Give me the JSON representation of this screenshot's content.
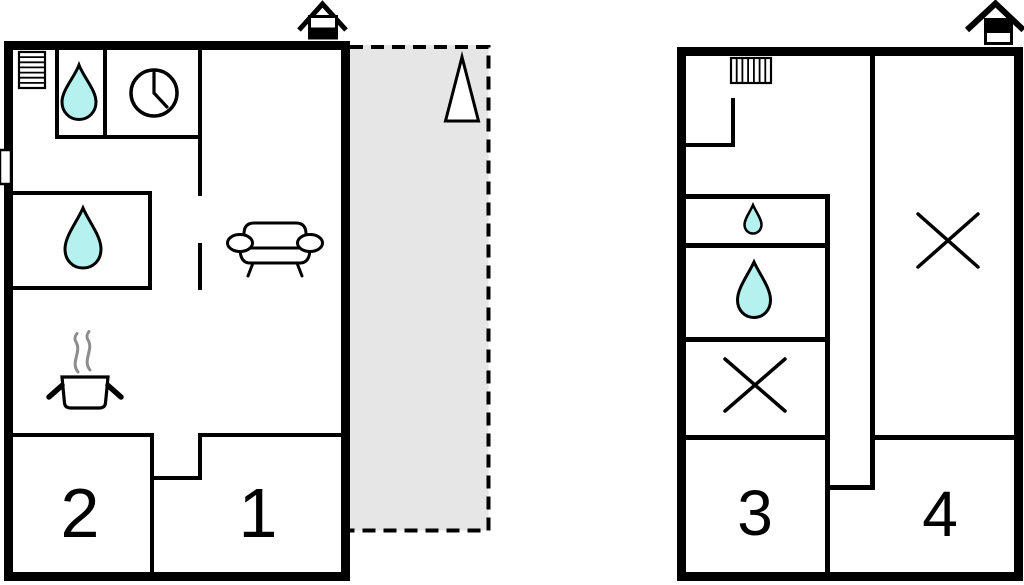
{
  "plan_title": "two-unit holiday house floor plan",
  "colors": {
    "wall": "#000000",
    "water": "#b5f1ef",
    "terrace": "#e6e6e6",
    "steam": "#8c8c8c",
    "icon_fill": "#ffffff"
  },
  "floors": {
    "left_building": {
      "room_labels": [
        "2",
        "1"
      ],
      "icons": [
        "entrance-house-icon",
        "radiator-icon",
        "water-drop-icon",
        "clock-icon",
        "window-icon",
        "water-drop-icon",
        "sofa-icon",
        "cooking-pot-icon",
        "steam-lines"
      ],
      "terrace": {
        "present": true,
        "icons": [
          "tree-icon"
        ]
      }
    },
    "right_building": {
      "room_labels": [
        "3",
        "4"
      ],
      "icons": [
        "entrance-house-icon",
        "radiator-icon",
        "water-drop-icon",
        "water-drop-icon",
        "cross-icon",
        "cross-icon"
      ]
    }
  }
}
